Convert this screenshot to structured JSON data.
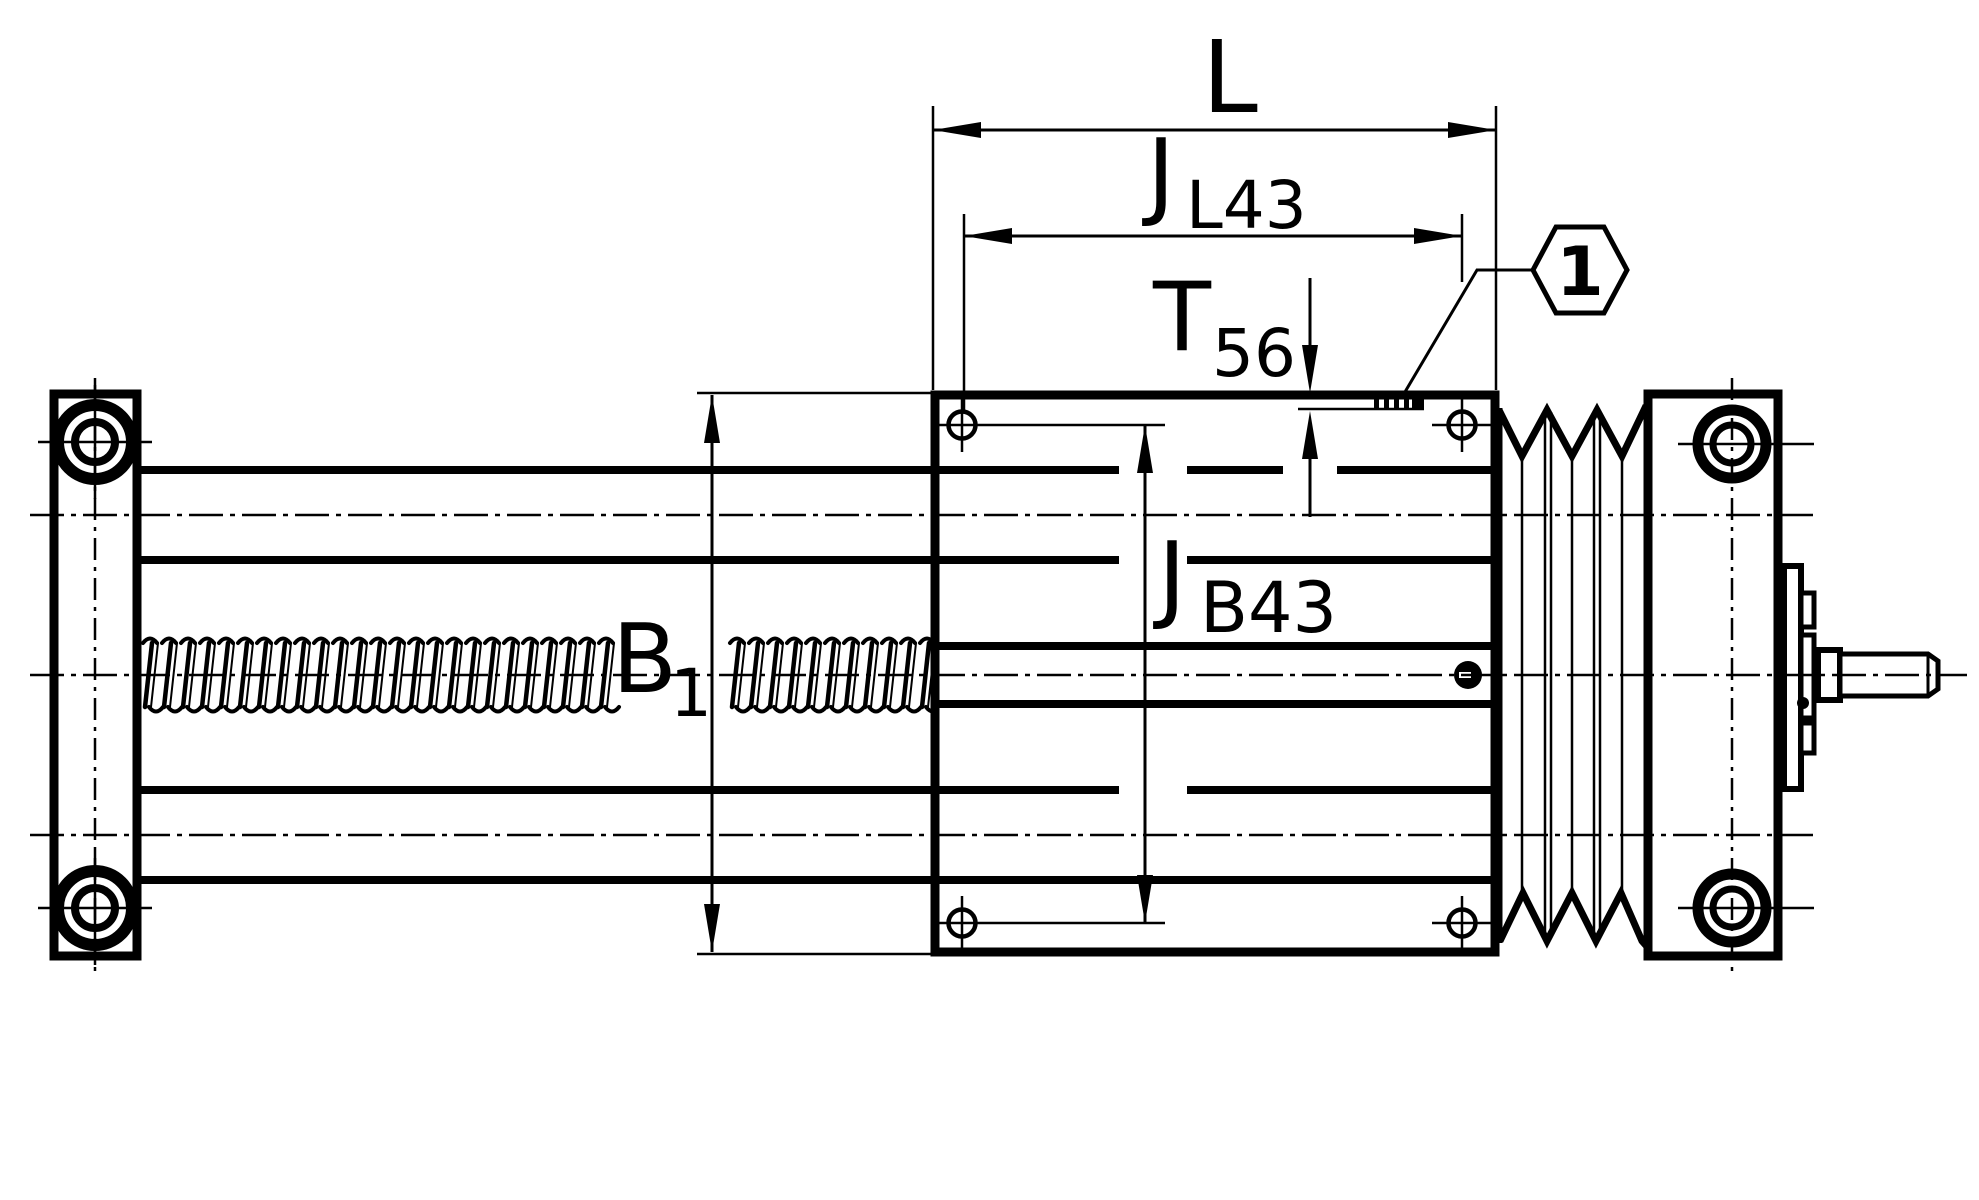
{
  "drawing": {
    "title": "linear-actuator-side-view",
    "ink": "#000000",
    "paper": "#ffffff",
    "dim_overall_length": {
      "main": "L",
      "sub": ""
    },
    "dim_hole_pitch_long": {
      "main": "J",
      "sub": "L43"
    },
    "dim_groove_depth": {
      "main": "T",
      "sub": "56"
    },
    "dim_body_width": {
      "main": "B",
      "sub": "1"
    },
    "dim_hole_pitch_cross": {
      "main": "J",
      "sub": "B43"
    },
    "callout_item_number": "1"
  }
}
